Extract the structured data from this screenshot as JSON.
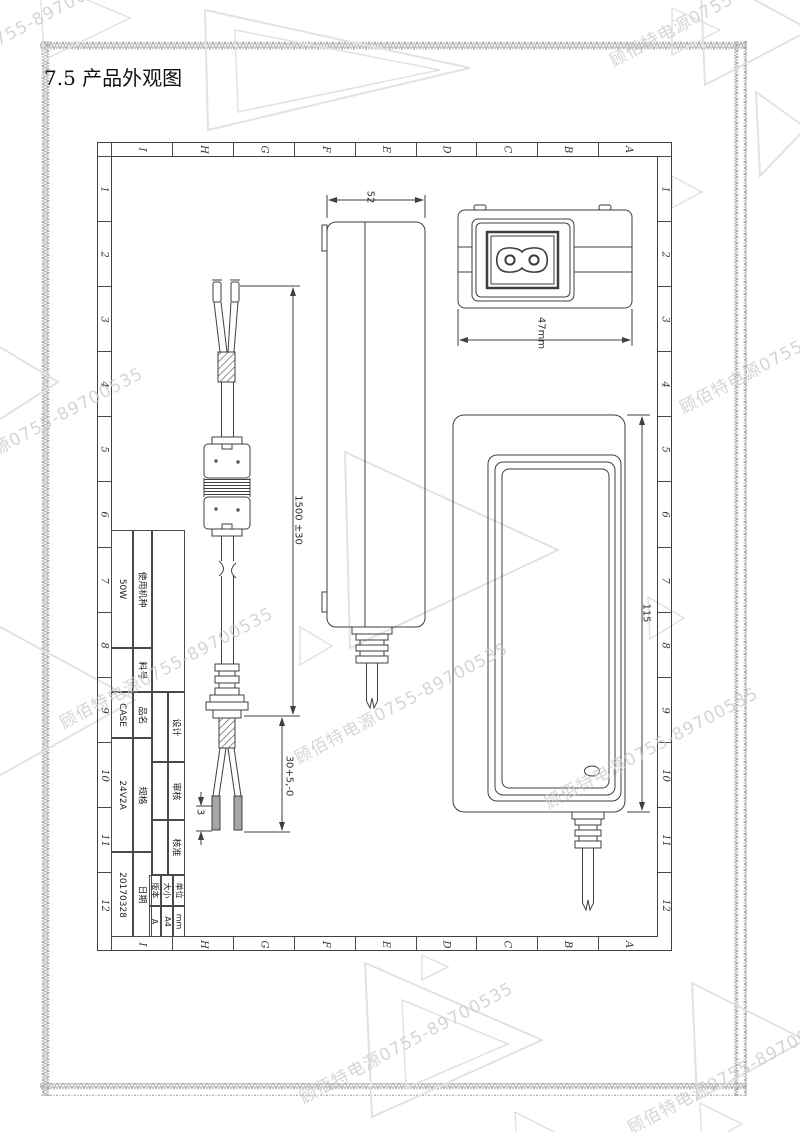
{
  "page": {
    "heading": "7.5 产品外观图"
  },
  "watermark": {
    "text": "顾佰特电源0755-89700535",
    "color": "#cbcbcb"
  },
  "grid": {
    "col_labels": [
      "I",
      "H",
      "G",
      "F",
      "E",
      "D",
      "C",
      "B",
      "A"
    ],
    "row_labels": [
      "1",
      "2",
      "3",
      "4",
      "5",
      "6",
      "7",
      "8",
      "9",
      "10",
      "11",
      "12"
    ]
  },
  "title_block": {
    "fields": [
      {
        "label": "使用机种",
        "value": "50W"
      },
      {
        "label": "料号",
        "value": ""
      },
      {
        "label": "品名",
        "value": "CASE"
      },
      {
        "label": "规格",
        "value": "24V2A"
      },
      {
        "label": "日期",
        "value": "20170328"
      }
    ],
    "approvals": [
      {
        "label": "设计"
      },
      {
        "label": "审核"
      },
      {
        "label": "核准"
      }
    ],
    "meta": [
      {
        "label": "版本",
        "value": "A"
      },
      {
        "label": "大小",
        "value": "A4"
      },
      {
        "label": "单位",
        "value": "mm"
      }
    ]
  },
  "drawing": {
    "dims": {
      "cable_length": "1500 ±30",
      "strip_length": "30+5,-0",
      "tip_length": "3",
      "body_width": "52",
      "inlet_width": "47mm",
      "body_height": "115"
    },
    "line_color": "#3f3f3f"
  }
}
